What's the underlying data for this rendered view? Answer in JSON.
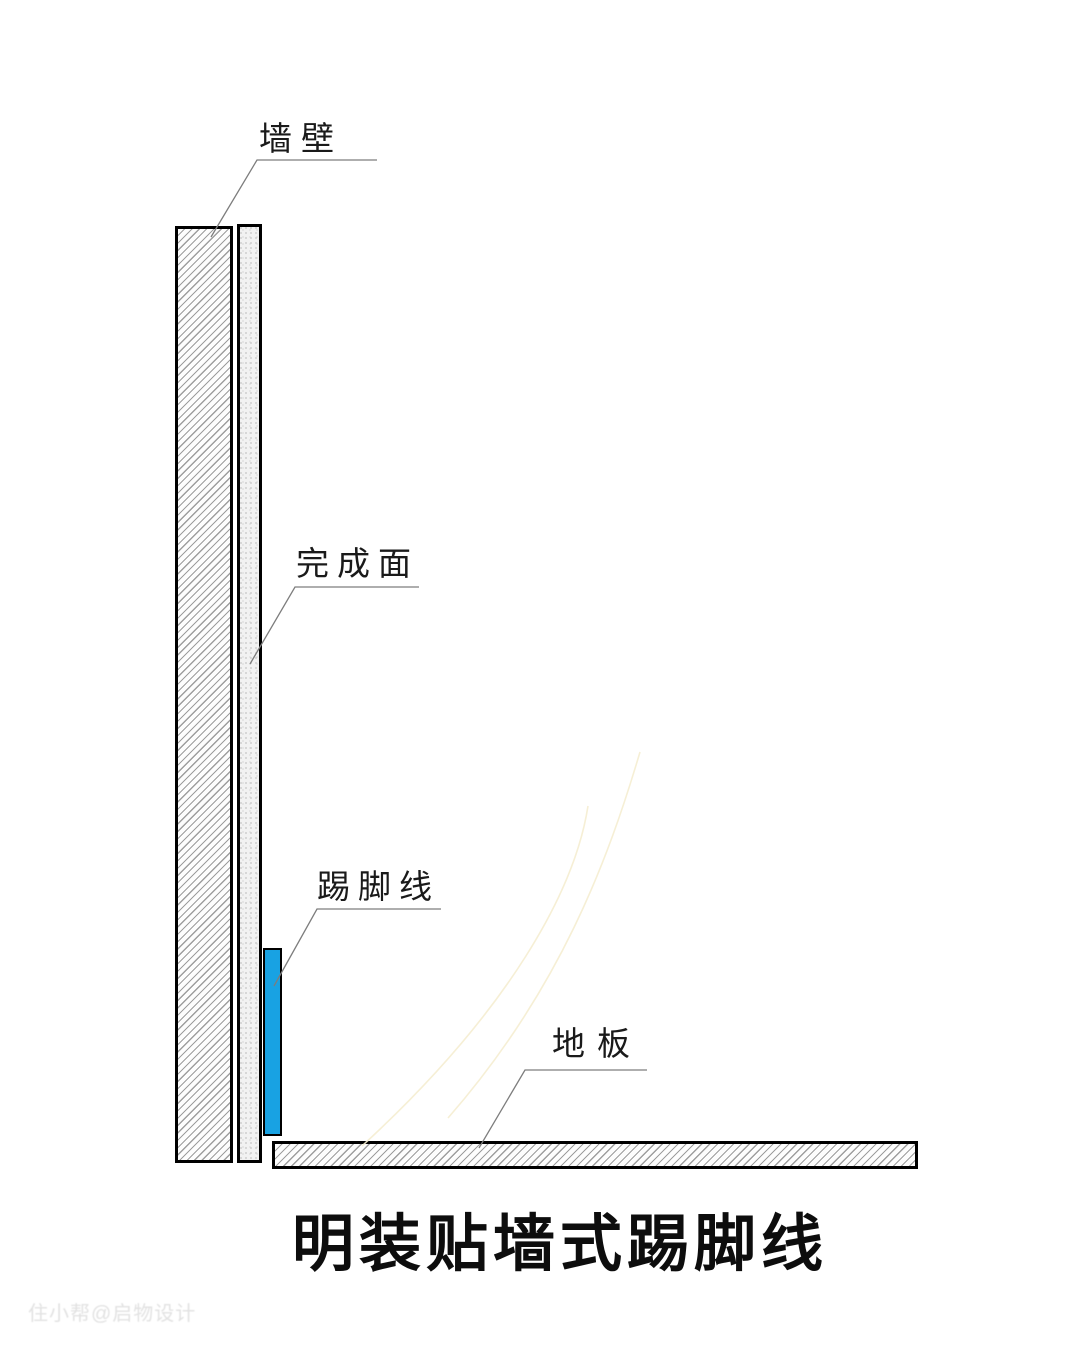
{
  "diagram": {
    "title": "明装贴墙式踢脚线",
    "watermark": "住小帮@启物设计",
    "labels": {
      "wall": "墙壁",
      "finish_surface": "完成面",
      "skirting": "踢脚线",
      "floor": "地板"
    },
    "colors": {
      "skirting_fill": "#18a2e3",
      "outline": "#000000",
      "leader_line": "#7d7d7d",
      "hatch_line": "#9e9e9e",
      "stipple_base": "#f2f2f2",
      "stipple_dot": "#c9c9c9",
      "title_color": "#0d0d0d",
      "label_color": "#1a1a1a",
      "watermark_color": "#e2e2e2",
      "scratch_color": "#f5edd0",
      "background": "#ffffff"
    }
  }
}
